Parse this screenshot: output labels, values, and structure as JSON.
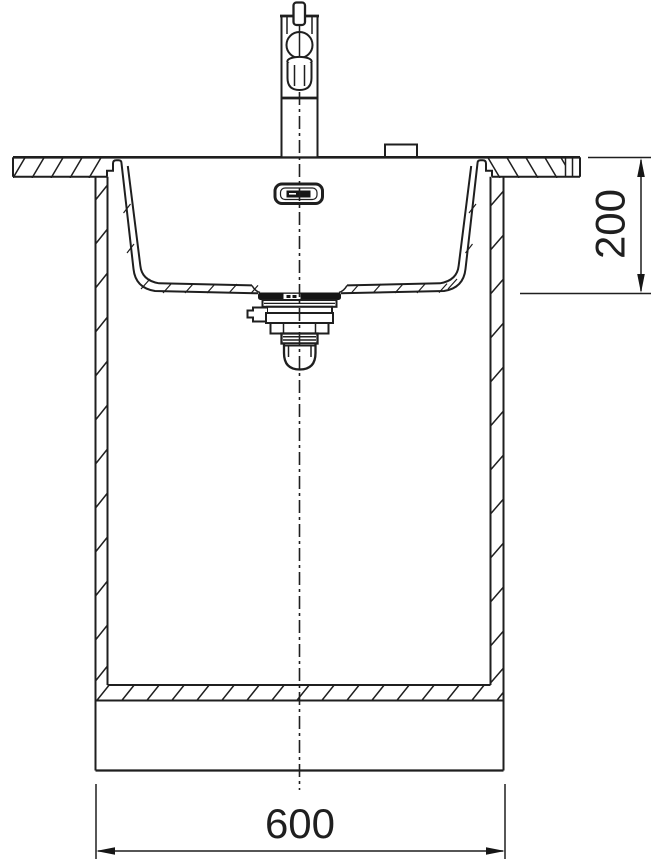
{
  "canvas": {
    "background": "#ffffff",
    "ink": "#1f1f1f"
  },
  "drawing": {
    "view": "front-section",
    "subject": "undermount kitchen sink with mixer tap in base cabinet",
    "dimensions": {
      "bowl_depth": {
        "label": "200"
      },
      "cabinet_width": {
        "label": "600"
      }
    },
    "components": [
      "mixer-tap",
      "tap-lever",
      "tap-spout",
      "tap-hole-cover",
      "countertop",
      "sink-bowl",
      "overflow-outlet",
      "waste-strainer",
      "siphon-cup",
      "cabinet-side-panel",
      "cabinet-bottom-shelf",
      "plinth",
      "center-line",
      "dimension-lines"
    ]
  }
}
